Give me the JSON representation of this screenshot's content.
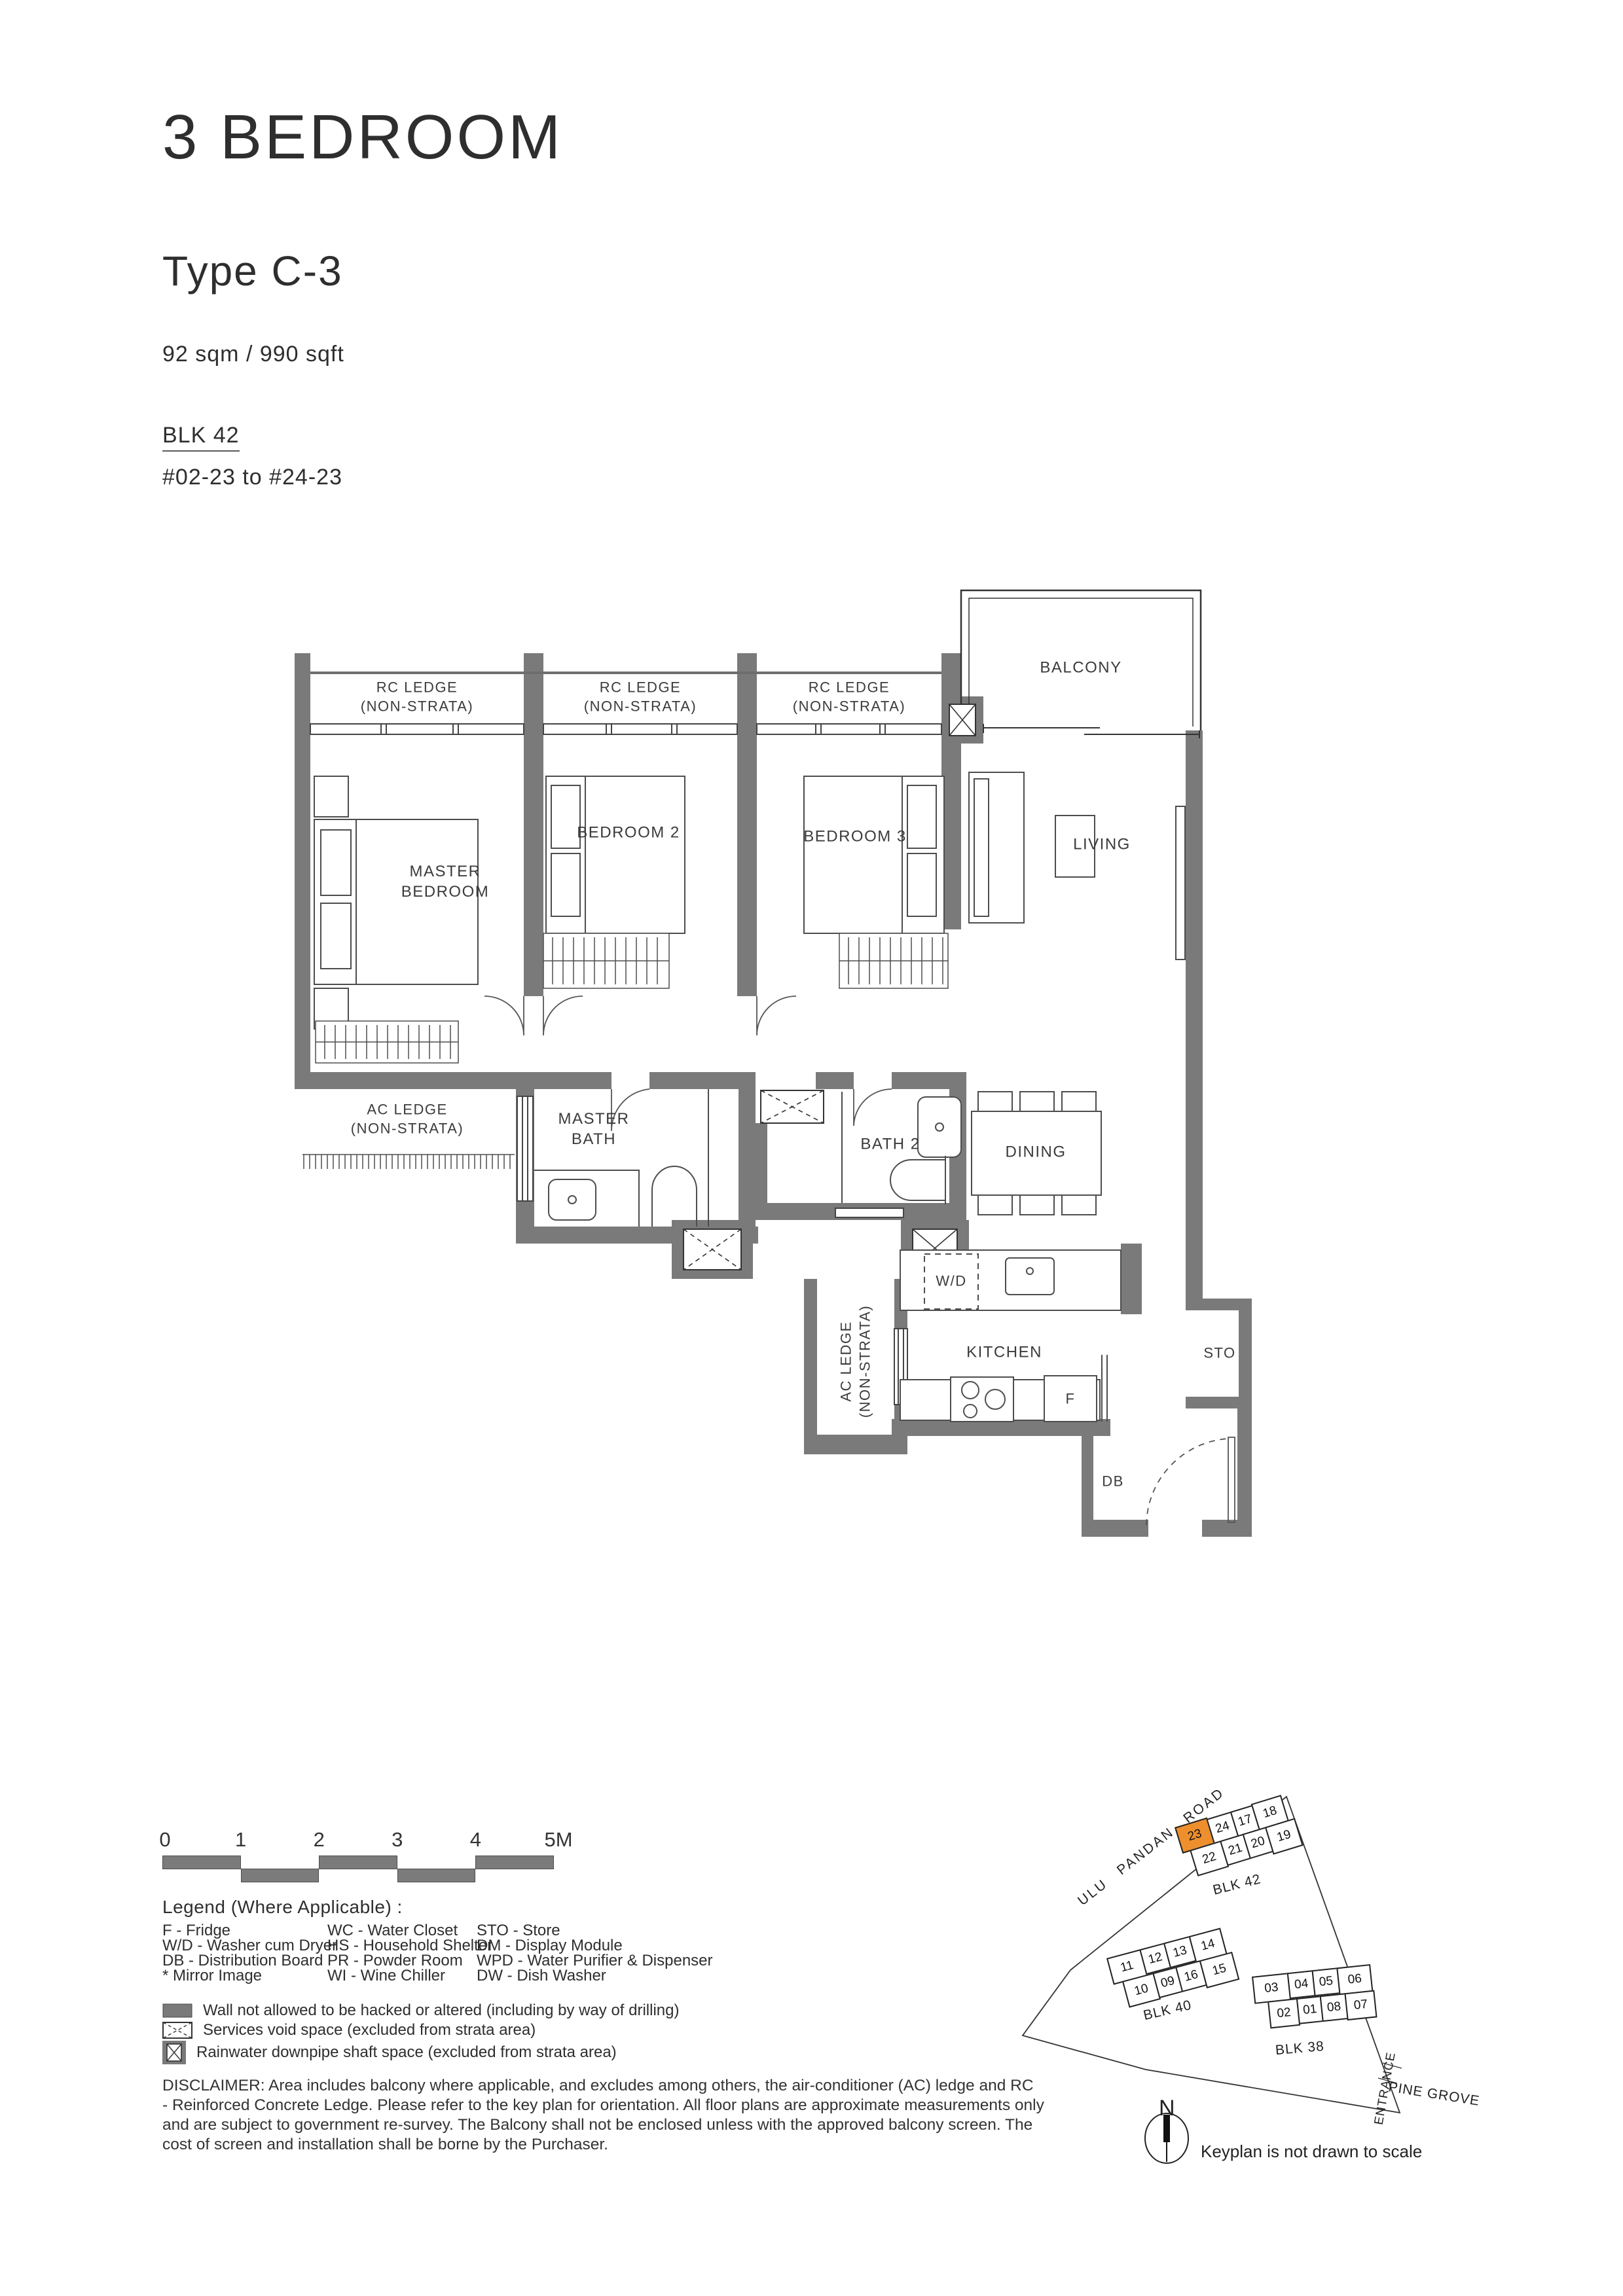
{
  "header": {
    "title": "3 BEDROOM",
    "type": "Type C-3",
    "area": "92 sqm / 990 sqft",
    "block": "BLK 42",
    "units": "#02-23 to #24-23"
  },
  "plan": {
    "rc_ledge": "RC LEDGE\n(NON-STRATA)",
    "balcony": "BALCONY",
    "master_bedroom": "MASTER\nBEDROOM",
    "bedroom2": "BEDROOM 2",
    "bedroom3": "BEDROOM 3",
    "living": "LIVING",
    "ac_ledge": "AC LEDGE\n(NON-STRATA)",
    "master_bath": "MASTER\nBATH",
    "bath2": "BATH 2",
    "dining": "DINING",
    "wd": "W/D",
    "kitchen": "KITCHEN",
    "fridge": "F",
    "store": "STO",
    "db": "DB",
    "wall_color": "#7a7a7a"
  },
  "scale_bar": {
    "labels": [
      "0",
      "1",
      "2",
      "3",
      "4",
      "5M"
    ]
  },
  "legend": {
    "title": "Legend (Where Applicable) :",
    "columns": [
      [
        "F - Fridge",
        "W/D - Washer cum Dryer",
        "DB - Distribution Board",
        "* Mirror Image"
      ],
      [
        "WC - Water Closet",
        "HS - Household Shelter",
        "PR - Powder Room",
        "WI  - Wine Chiller"
      ],
      [
        "STO - Store",
        "DM - Display Module",
        "WPD - Water Purifier & Dispenser",
        "DW - Dish Washer"
      ]
    ],
    "symbols": [
      "Wall not allowed to be hacked or altered (including by way of drilling)",
      "Services void space (excluded from strata area)",
      "Rainwater downpipe shaft space (excluded from strata area)"
    ]
  },
  "disclaimer": "DISCLAIMER: Area includes balcony where applicable, and excludes among others, the air-conditioner (AC) ledge and RC\n- Reinforced Concrete Ledge. Please refer to the key plan for orientation. All floor plans are approximate measurements only\nand are subject to government re-survey. The Balcony shall not be enclosed unless with the approved balcony screen. The\ncost of screen and installation shall be borne by the Purchaser.",
  "keyplan": {
    "road": "ULU  PANDAN  ROAD",
    "pine_grove": "PINE GROVE",
    "entrance": "ENTRANCE",
    "north": "N",
    "note": "Keyplan is not drawn to scale",
    "highlight_color": "#EE8F2E",
    "highlight_unit": "23",
    "blk42": {
      "label": "BLK 42",
      "row1": [
        "23",
        "24",
        "17",
        "18"
      ],
      "row2": [
        "22",
        "21",
        "20",
        "19"
      ]
    },
    "blk40": {
      "label": "BLK 40",
      "row1": [
        "11",
        "12",
        "13",
        "14"
      ],
      "row2": [
        "10",
        "09",
        "16",
        "15"
      ]
    },
    "blk38": {
      "label": "BLK 38",
      "row1": [
        "03",
        "04",
        "05",
        "06"
      ],
      "row2": [
        "02",
        "01",
        "08",
        "07"
      ]
    }
  }
}
